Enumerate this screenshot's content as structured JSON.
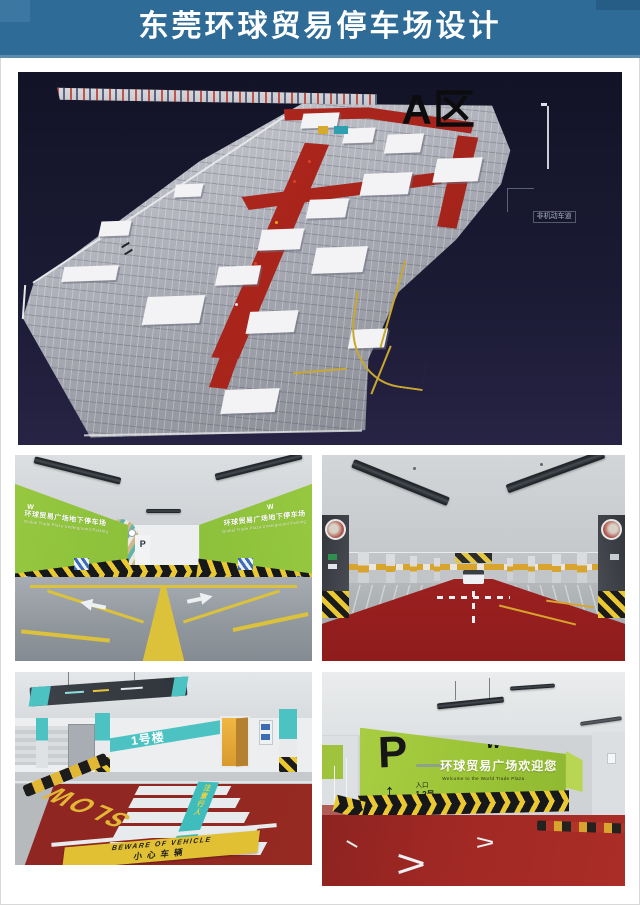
{
  "header": {
    "title": "东莞环球贸易停车场设计"
  },
  "map": {
    "area_label": "A区",
    "lane_label": "非机动车道"
  },
  "photo_entrance": {
    "wall_text_cn": "环球贸易广场地下停车场",
    "wall_text_en": "Global Trade Plaza Underground Parking",
    "logo": "W",
    "p_sign": "P"
  },
  "photo_crosswalk": {
    "building_sign": "1号楼",
    "slow_text": "SLOW",
    "pedestrian_text": "注意行人",
    "banner_en": "BEWARE OF VEHICLE",
    "banner_cn": "小心车辆"
  },
  "photo_welcome": {
    "p_sign": "P",
    "arrow_up": "↑",
    "entrance_l1": "入口",
    "entrance_l2": "1.2号",
    "logo": "W",
    "welcome_cn": "环球贸易广场欢迎您",
    "welcome_en": "Welcome to the World Trade Plaza"
  },
  "colors": {
    "header_blue": "#2e6b96",
    "map_background": "#1a1a33",
    "aisle_red": "#a8241c",
    "plate_gray": "#a9abb5",
    "wall_green": "#9cc437",
    "floor_red": "#93271f",
    "teal_accent": "#4cc2c2",
    "hazard_yellow": "#e9c832"
  }
}
